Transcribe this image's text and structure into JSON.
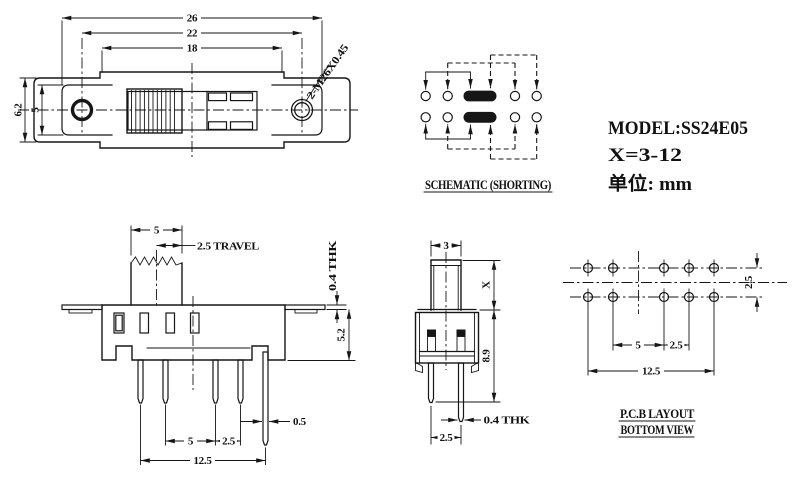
{
  "title_block": {
    "model": "MODEL:SS24E05",
    "x_range": "X=3-12",
    "unit": "单位: mm"
  },
  "top_view": {
    "label_26": "26",
    "label_22": "22",
    "label_18": "18",
    "label_62": "6.2",
    "label_5": "5",
    "thread_callout": "2-M26X0.45"
  },
  "schematic": {
    "caption": "SCHEMATIC (SHORTING)"
  },
  "front_view": {
    "label_knob_5": "5",
    "label_travel": "2.5 TRAVEL",
    "label_thk": "0.4 THK",
    "label_52": "5.2",
    "label_05": "0.5",
    "label_5": "5",
    "label_25": "2.5",
    "label_125": "12.5"
  },
  "side_view": {
    "label_3": "3",
    "label_x": "X",
    "label_89": "8.9",
    "label_thk": "0.4 THK",
    "label_25": "2.5"
  },
  "pcb": {
    "caption_1": "P.C.B LAYOUT",
    "caption_2": "BOTTOM VIEW",
    "label_row_25": "2.5",
    "label_5": "5",
    "label_25": "2.5",
    "label_125": "12.5"
  }
}
